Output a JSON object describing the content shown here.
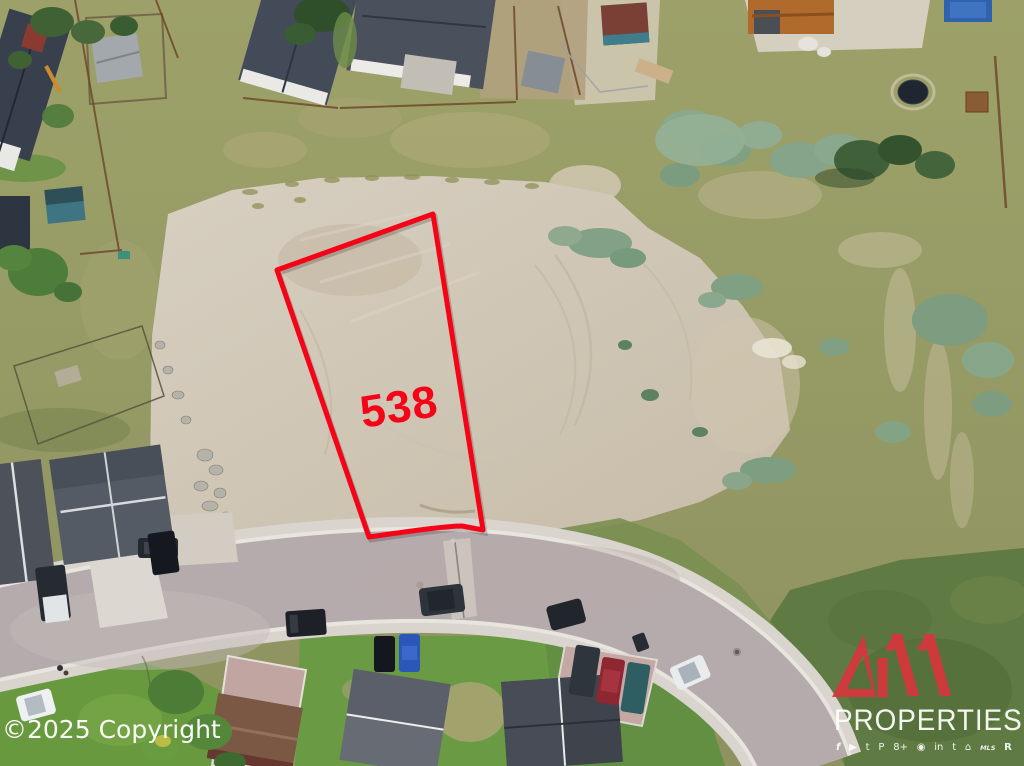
{
  "annotation": {
    "lot_number": "538",
    "boundary_color": "#f50418"
  },
  "watermark": {
    "text": "©2025 Copyright",
    "text_color": "#ffffff"
  },
  "brand": {
    "number": "411",
    "name": "PROPERTIES",
    "logo_red": "#d8363c",
    "text_color": "#ffffff",
    "icons": [
      {
        "name": "facebook",
        "glyph": "f"
      },
      {
        "name": "youtube",
        "glyph": "▶"
      },
      {
        "name": "twitter",
        "glyph": "t"
      },
      {
        "name": "pinterest",
        "glyph": "P"
      },
      {
        "name": "google-plus",
        "glyph": "8+"
      },
      {
        "name": "instagram",
        "glyph": "◉"
      },
      {
        "name": "linkedin",
        "glyph": "in"
      },
      {
        "name": "bird",
        "glyph": "t"
      },
      {
        "name": "equal-housing",
        "glyph": "⌂"
      },
      {
        "name": "mls",
        "glyph": "MLS"
      },
      {
        "name": "realtor",
        "glyph": "R"
      }
    ]
  }
}
